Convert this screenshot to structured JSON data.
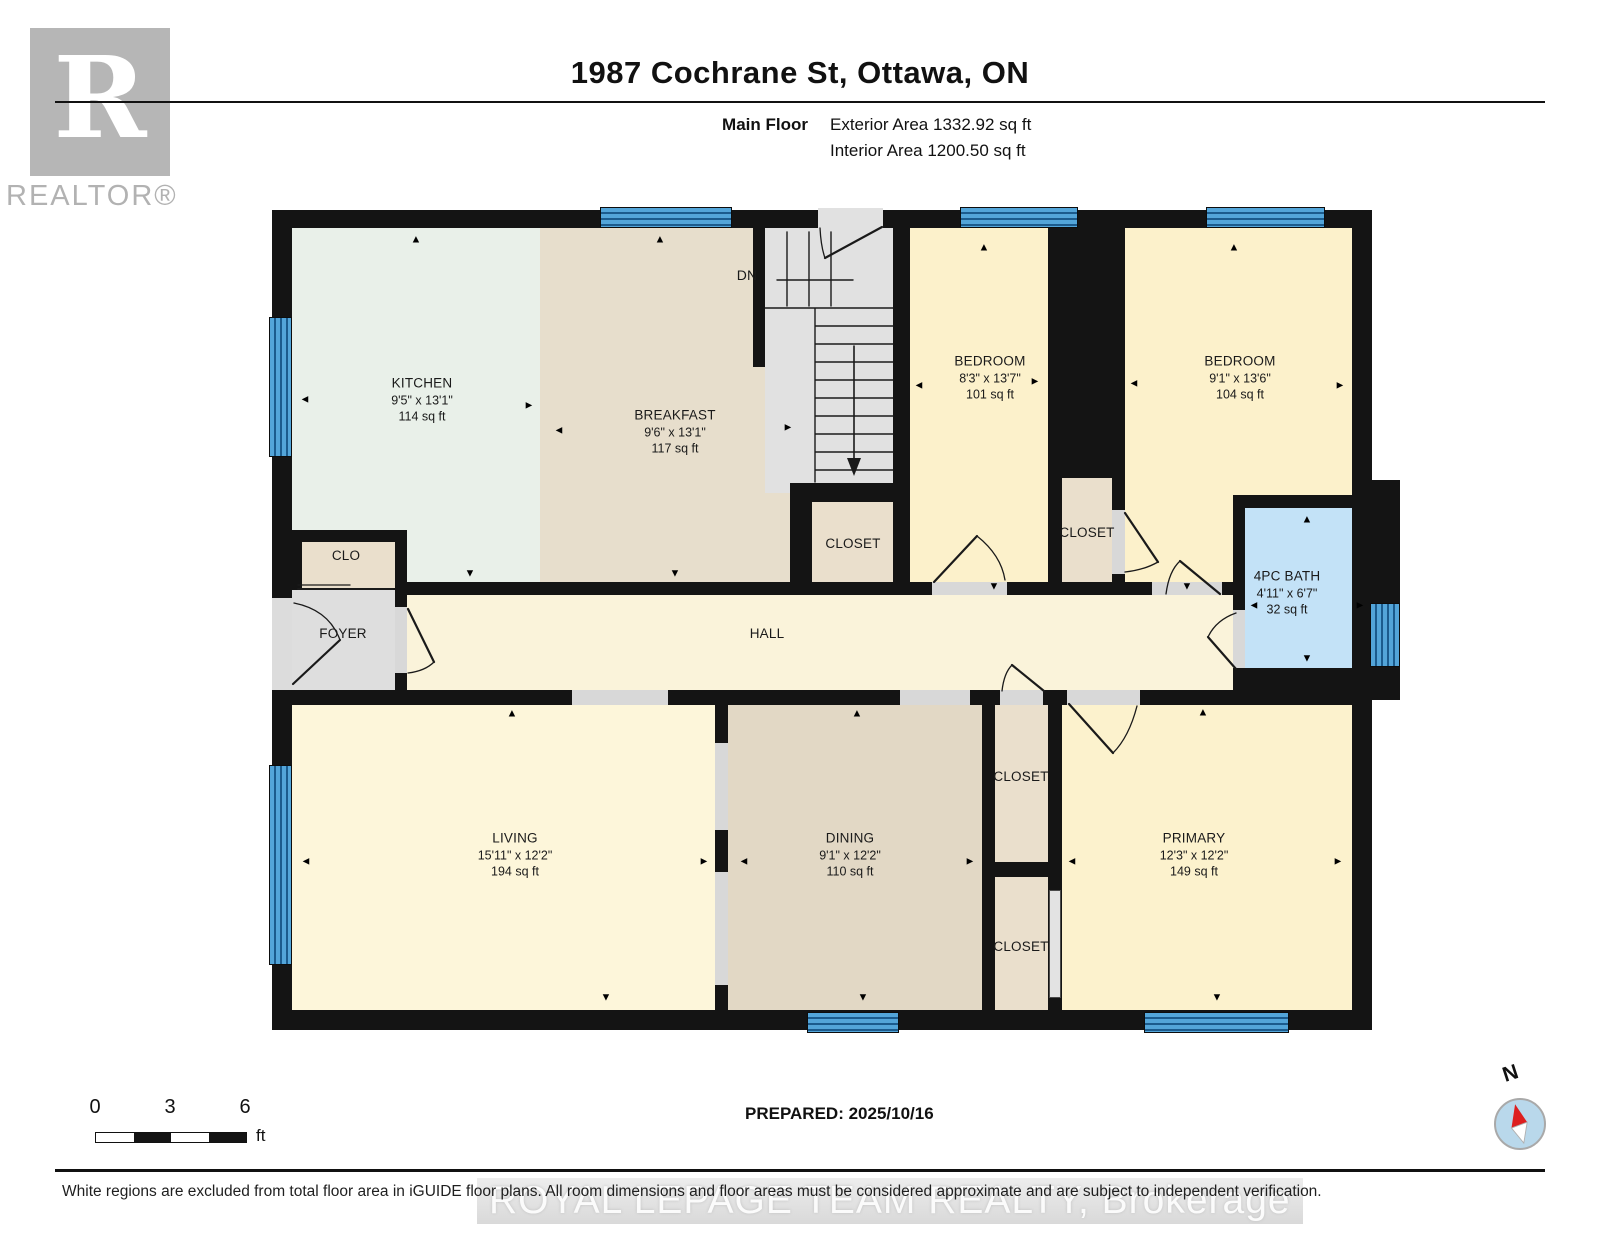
{
  "header": {
    "title": "1987 Cochrane St, Ottawa, ON",
    "floor_label": "Main Floor",
    "exterior_area": "Exterior Area 1332.92 sq ft",
    "interior_area": "Interior Area 1200.50 sq ft",
    "logo_letter": "R",
    "logo_wordmark": "REALTOR®"
  },
  "plan": {
    "stairs_dn_label": "DN",
    "icons": {
      "up": "▲",
      "down": "▼",
      "left": "◄",
      "right": "►"
    },
    "rooms": {
      "kitchen": {
        "name": "KITCHEN",
        "dims": "9'5\" x 13'1\"",
        "area": "114 sq ft"
      },
      "breakfast": {
        "name": "BREAKFAST",
        "dims": "9'6\" x 13'1\"",
        "area": "117 sq ft"
      },
      "bedroom1": {
        "name": "BEDROOM",
        "dims": "8'3\" x 13'7\"",
        "area": "101 sq ft"
      },
      "bedroom2": {
        "name": "BEDROOM",
        "dims": "9'1\" x 13'6\"",
        "area": "104 sq ft"
      },
      "bath": {
        "name": "4PC BATH",
        "dims": "4'11\" x 6'7\"",
        "area": "32 sq ft"
      },
      "living": {
        "name": "LIVING",
        "dims": "15'11\" x 12'2\"",
        "area": "194 sq ft"
      },
      "dining": {
        "name": "DINING",
        "dims": "9'1\" x 12'2\"",
        "area": "110 sq ft"
      },
      "primary": {
        "name": "PRIMARY",
        "dims": "12'3\" x 12'2\"",
        "area": "149 sq ft"
      },
      "hall": {
        "name": "HALL"
      },
      "foyer": {
        "name": "FOYER"
      },
      "clo": {
        "name": "CLO"
      },
      "closet_stairs": {
        "name": "CLOSET"
      },
      "closet_mid": {
        "name": "CLOSET"
      },
      "closet_top": {
        "name": "CLOSET"
      },
      "closet_bottom": {
        "name": "CLOSET"
      }
    },
    "colors": {
      "wall": "#141414",
      "window": "#53a5d9",
      "bath": "#c3e2f7",
      "bedroom": "#fcf1cb",
      "living": "#fdf6da",
      "tan": "#e6ddca",
      "closet": "#eadfcc",
      "kitchen_mint": "#e9f0e9",
      "gray_floor": "#e0e0e0",
      "compass_needle": "#dd1f1f"
    }
  },
  "footer": {
    "scale_ticks": [
      "0",
      "3",
      "6"
    ],
    "scale_unit": "ft",
    "prepared": "PREPARED: 2025/10/16",
    "compass_label": "N",
    "disclaimer": "White regions are excluded from total floor area in iGUIDE floor plans. All room dimensions and floor areas must be considered approximate and are subject to independent verification.",
    "watermark": "ROYAL LEPAGE TEAM REALTY, Brokerage"
  }
}
